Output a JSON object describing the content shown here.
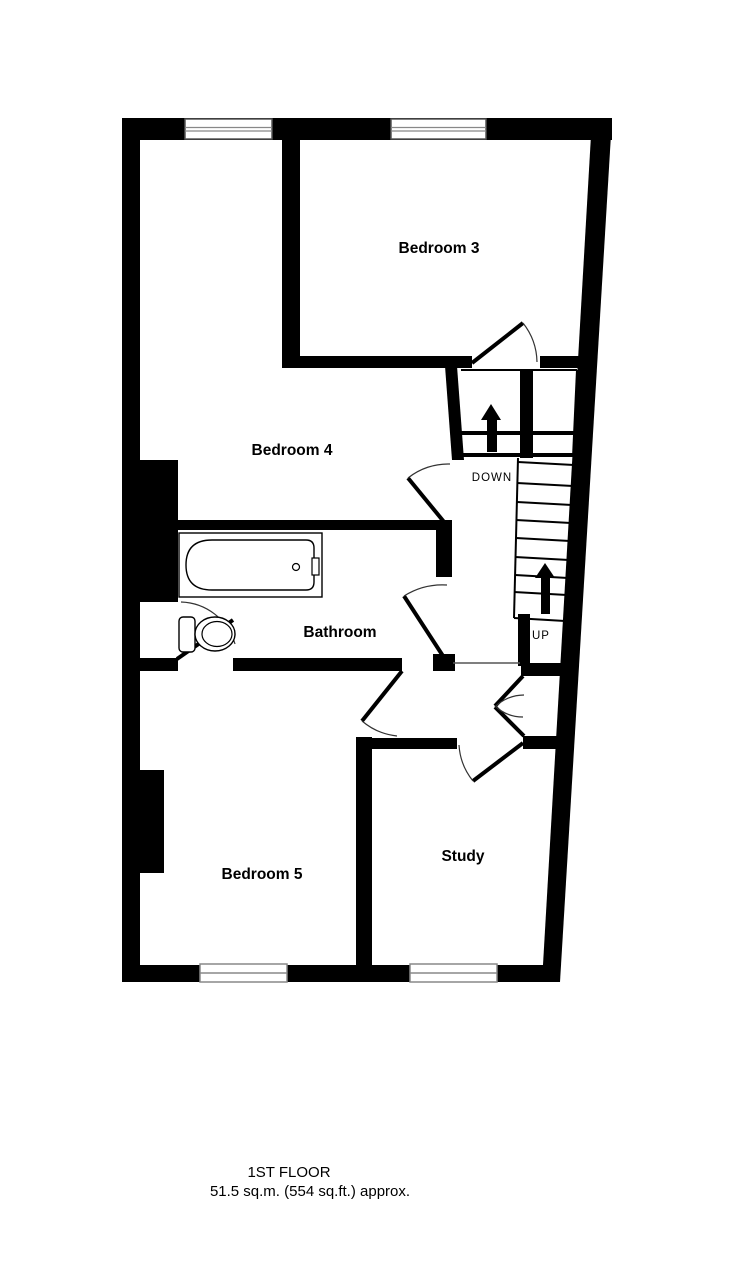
{
  "floorplan": {
    "rooms": {
      "bedroom3": {
        "label": "Bedroom 3"
      },
      "bedroom4": {
        "label": "Bedroom 4"
      },
      "bathroom": {
        "label": "Bathroom"
      },
      "bedroom5": {
        "label": "Bedroom 5"
      },
      "study": {
        "label": "Study"
      }
    },
    "stairs": {
      "down_label": "DOWN",
      "up_label": "UP"
    },
    "caption": {
      "line1": "1ST FLOOR",
      "line2": "51.5 sq.m. (554 sq.ft.) approx."
    },
    "colors": {
      "wall": "#000000",
      "background": "#ffffff",
      "arc": "#333333",
      "window_line": "#888888"
    }
  }
}
